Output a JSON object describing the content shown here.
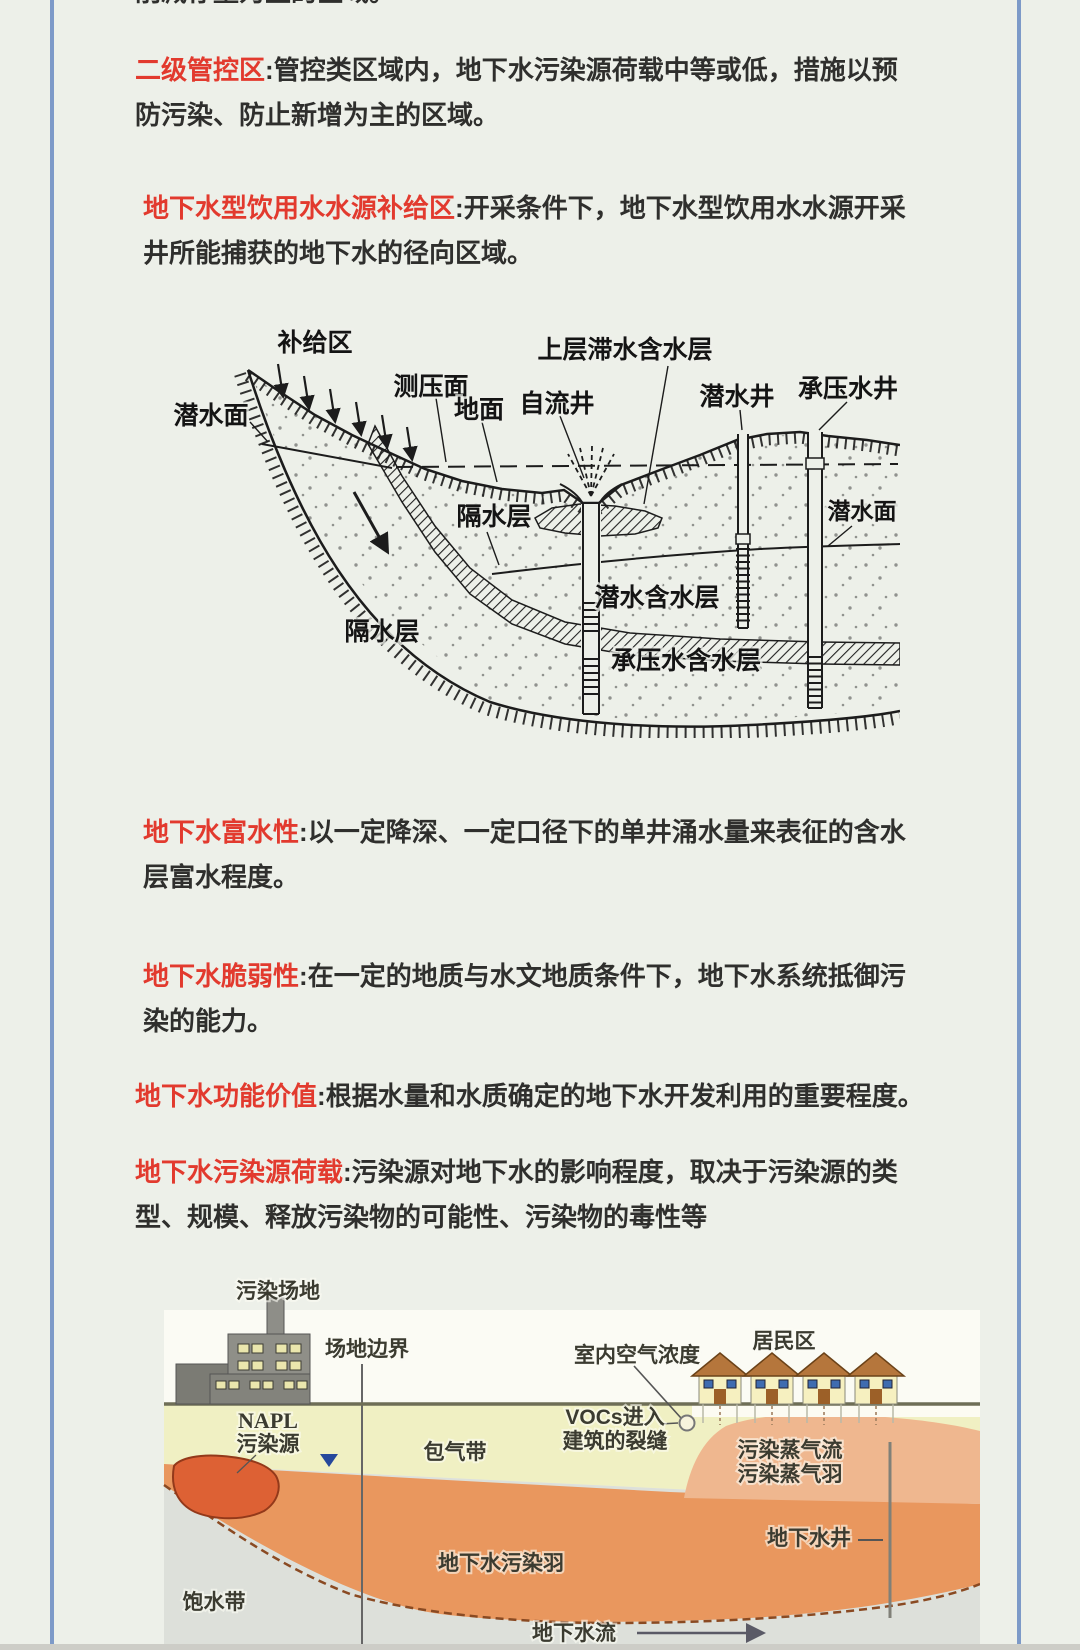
{
  "page": {
    "background": "#edf0e9",
    "frame_color": "#7d9ac8",
    "accent_red": "#e23a2e",
    "body_text_color": "#2f2f2d"
  },
  "ui": {
    "colon": ":"
  },
  "top_clipped_line": "削减存量为主的区域。",
  "paragraphs": [
    {
      "term": "二级管控区",
      "body": "管控类区域内，地下水污染源荷载中等或低，措施以预防污染、防止新增为主的区域。"
    },
    {
      "term": "地下水型饮用水水源补给区",
      "body": "开采条件下，地下水型饮用水水源开采井所能捕获的地下水的径向区域。"
    },
    {
      "term": "地下水富水性",
      "body": "以一定降深、一定口径下的单井涌水量来表征的含水层富水程度。"
    },
    {
      "term": "地下水脆弱性",
      "body": "在一定的地质与水文地质条件下，地下水系统抵御污染的能力。"
    },
    {
      "term": "地下水功能价值",
      "body": "根据水量和水质确定的地下水开发利用的重要程度。"
    },
    {
      "term": "地下水污染源荷载",
      "body": "污染源对地下水的影响程度，取决于污染源的类型、规模、释放污染物的可能性、污染物的毒性等"
    }
  ],
  "hydrogeology_diagram": {
    "labels": {
      "recharge_area": "补给区",
      "water_table_left": "潜水面",
      "piezometric_surface": "测压面",
      "ground_surface": "地面",
      "artesian_well": "自流井",
      "perched_aquifer": "上层滞水含水层",
      "phreatic_well": "潜水井",
      "confined_well": "承压水井",
      "water_table_right": "潜水面",
      "aquitard_upper": "隔水层",
      "phreatic_aquifer": "潜水含水层",
      "aquitard_lower": "隔水层",
      "confined_aquifer": "承压水含水层"
    }
  },
  "pollution_diagram": {
    "labels": {
      "contaminated_site": "污染场地",
      "site_boundary": "场地边界",
      "indoor_air_concentration": "室内空气浓度",
      "residential_area": "居民区",
      "vocs_line1": "VOCs进入",
      "vocs_line2": "建筑的裂缝",
      "napl_line1": "NAPL",
      "napl_line2": "污染源",
      "vadose_zone": "包气带",
      "vapor_flow": "污染蒸气流",
      "vapor_plume": "污染蒸气羽",
      "groundwater_well": "地下水井",
      "groundwater_pollution_plume": "地下水污染羽",
      "saturated_zone": "饱水带",
      "groundwater_flow": "地下水流"
    },
    "colors": {
      "sky": "#fbfbf4",
      "vadose": "#f0f0c3",
      "saturated": "#dde0da",
      "plume": "#e9975e",
      "vapor_mound": "#efb78f",
      "napl": "#dd6134",
      "ground_line": "#6e6e56"
    }
  }
}
